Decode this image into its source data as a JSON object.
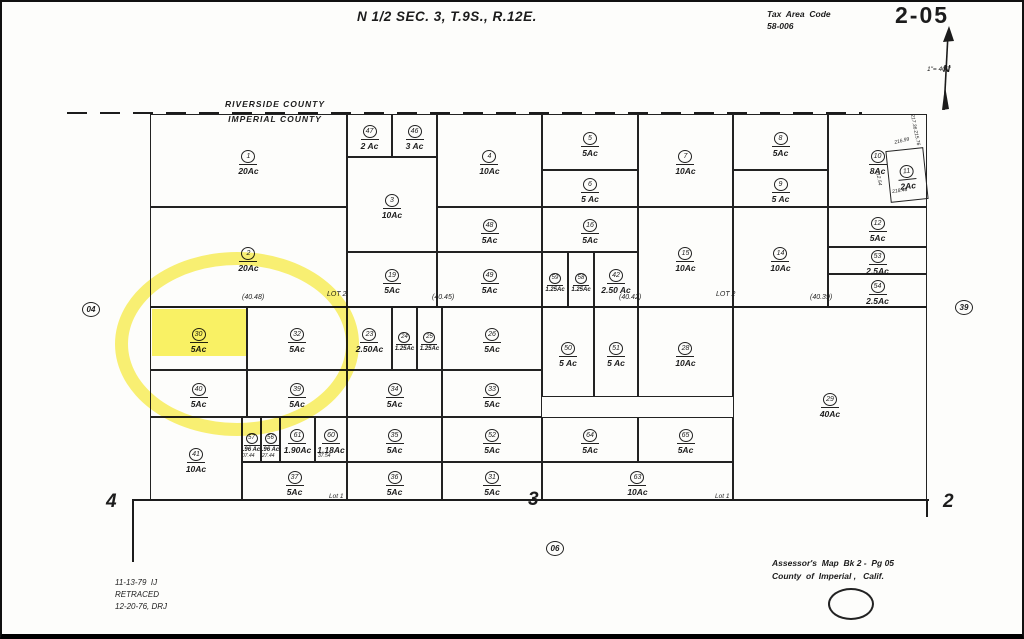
{
  "page": {
    "title": "N 1/2  SEC. 3,  T.9S.,  R.12E.",
    "tax_area_code_label": "Tax  Area  Code",
    "tax_area_code": "58-006",
    "page_number": "2-05",
    "scale": "1\"= 400'",
    "north_label": "N"
  },
  "county_line": {
    "top": "RIVERSIDE  COUNTY",
    "bottom": "IMPERIAL  COUNTY"
  },
  "footer": {
    "note_line1": "11-13-79  IJ",
    "note_line2": "RETRACED",
    "note_line3": "12-20-76, DRJ",
    "credit_line1": "Assessor's  Map  Bk 2 -  Pg 05",
    "credit_line2": "County  of  Imperial ,   Calif."
  },
  "highlight": {
    "color_stroke": "rgba(247,233,30,0.62)",
    "color_fill": "rgba(249,238,42,0.72)",
    "ellipse": {
      "x": 113,
      "y": 250,
      "w": 218,
      "h": 158
    },
    "rect": {
      "x": 150,
      "y": 307,
      "w": 94,
      "h": 47
    }
  },
  "map": {
    "parcels": [
      {
        "id": "1",
        "acres": "20Ac",
        "x": 148,
        "y": 112,
        "w": 197,
        "h": 93
      },
      {
        "id": "47",
        "acres": "2 Ac",
        "x": 345,
        "y": 112,
        "w": 45,
        "h": 43
      },
      {
        "id": "46",
        "acres": "3 Ac",
        "x": 390,
        "y": 112,
        "w": 45,
        "h": 43
      },
      {
        "id": "4",
        "acres": "10Ac",
        "x": 435,
        "y": 112,
        "w": 105,
        "h": 93
      },
      {
        "id": "5",
        "acres": "5Ac",
        "x": 540,
        "y": 112,
        "w": 96,
        "h": 56
      },
      {
        "id": "6",
        "acres": "5 Ac",
        "x": 540,
        "y": 168,
        "w": 96,
        "h": 37
      },
      {
        "id": "7",
        "acres": "10Ac",
        "x": 636,
        "y": 112,
        "w": 95,
        "h": 93
      },
      {
        "id": "8",
        "acres": "5Ac",
        "x": 731,
        "y": 112,
        "w": 95,
        "h": 56
      },
      {
        "id": "9",
        "acres": "5 Ac",
        "x": 731,
        "y": 168,
        "w": 95,
        "h": 37
      },
      {
        "id": "10",
        "acres": "8Ac",
        "x": 826,
        "y": 112,
        "w": 99,
        "h": 93
      },
      {
        "id": "3",
        "acres": "10Ac",
        "x": 345,
        "y": 155,
        "w": 90,
        "h": 95
      },
      {
        "id": "48",
        "acres": "5Ac",
        "x": 435,
        "y": 205,
        "w": 105,
        "h": 45
      },
      {
        "id": "16",
        "acres": "5Ac",
        "x": 540,
        "y": 205,
        "w": 96,
        "h": 45
      },
      {
        "id": "12",
        "acres": "5Ac",
        "x": 826,
        "y": 205,
        "w": 99,
        "h": 40
      },
      {
        "id": "2",
        "acres": "20Ac",
        "x": 148,
        "y": 205,
        "w": 197,
        "h": 100
      },
      {
        "id": "19",
        "acres": "5Ac",
        "x": 345,
        "y": 250,
        "w": 90,
        "h": 55
      },
      {
        "id": "49",
        "acres": "5Ac",
        "x": 435,
        "y": 250,
        "w": 105,
        "h": 55
      },
      {
        "id": "59",
        "acres": "1.25Ac",
        "x": 540,
        "y": 250,
        "w": 26,
        "h": 55
      },
      {
        "id": "58",
        "acres": "1.25Ac",
        "x": 566,
        "y": 250,
        "w": 26,
        "h": 55
      },
      {
        "id": "42",
        "acres": "2.50 Ac",
        "x": 592,
        "y": 250,
        "w": 44,
        "h": 55
      },
      {
        "id": "15",
        "acres": "10Ac",
        "x": 636,
        "y": 205,
        "w": 95,
        "h": 100
      },
      {
        "id": "14",
        "acres": "10Ac",
        "x": 731,
        "y": 205,
        "w": 95,
        "h": 100
      },
      {
        "id": "53",
        "acres": "2.5Ac",
        "x": 826,
        "y": 245,
        "w": 99,
        "h": 27
      },
      {
        "id": "54",
        "acres": "2.5Ac",
        "x": 826,
        "y": 272,
        "w": 99,
        "h": 33
      },
      {
        "id": "30",
        "acres": "5Ac",
        "x": 148,
        "y": 305,
        "w": 97,
        "h": 63
      },
      {
        "id": "32",
        "acres": "5Ac",
        "x": 245,
        "y": 305,
        "w": 100,
        "h": 63
      },
      {
        "id": "23",
        "acres": "2.50Ac",
        "x": 345,
        "y": 305,
        "w": 45,
        "h": 63
      },
      {
        "id": "24",
        "acres": "1.25Ac",
        "x": 390,
        "y": 305,
        "w": 25,
        "h": 63
      },
      {
        "id": "25",
        "acres": "1.25Ac",
        "x": 415,
        "y": 305,
        "w": 25,
        "h": 63
      },
      {
        "id": "26",
        "acres": "5Ac",
        "x": 440,
        "y": 305,
        "w": 100,
        "h": 63
      },
      {
        "id": "50",
        "acres": "5 Ac",
        "x": 540,
        "y": 305,
        "w": 52,
        "h": 90
      },
      {
        "id": "51",
        "acres": "5 Ac",
        "x": 592,
        "y": 305,
        "w": 44,
        "h": 90
      },
      {
        "id": "28",
        "acres": "10Ac",
        "x": 636,
        "y": 305,
        "w": 95,
        "h": 90
      },
      {
        "id": "29",
        "acres": "40Ac",
        "x": 731,
        "y": 305,
        "w": 194,
        "h": 193
      },
      {
        "id": "40",
        "acres": "5Ac",
        "x": 148,
        "y": 368,
        "w": 97,
        "h": 47
      },
      {
        "id": "39",
        "acres": "5Ac",
        "x": 245,
        "y": 368,
        "w": 100,
        "h": 47
      },
      {
        "id": "34",
        "acres": "5Ac",
        "x": 345,
        "y": 368,
        "w": 95,
        "h": 47
      },
      {
        "id": "33",
        "acres": "5Ac",
        "x": 440,
        "y": 368,
        "w": 100,
        "h": 47
      },
      {
        "id": "41",
        "acres": "10Ac",
        "x": 148,
        "y": 415,
        "w": 92,
        "h": 83
      },
      {
        "id": "57",
        "acres": ".96 Ac",
        "x": 240,
        "y": 415,
        "w": 19,
        "h": 45
      },
      {
        "id": "56",
        "acres": ".96 Ac",
        "x": 259,
        "y": 415,
        "w": 19,
        "h": 45
      },
      {
        "id": "61",
        "acres": "1.90Ac",
        "x": 278,
        "y": 415,
        "w": 35,
        "h": 45
      },
      {
        "id": "60",
        "acres": "1.18Ac",
        "x": 313,
        "y": 415,
        "w": 32,
        "h": 45
      },
      {
        "id": "35",
        "acres": "5Ac",
        "x": 345,
        "y": 415,
        "w": 95,
        "h": 45
      },
      {
        "id": "52",
        "acres": "5Ac",
        "x": 440,
        "y": 415,
        "w": 100,
        "h": 45
      },
      {
        "id": "64",
        "acres": "5Ac",
        "x": 540,
        "y": 415,
        "w": 96,
        "h": 45
      },
      {
        "id": "65",
        "acres": "5Ac",
        "x": 636,
        "y": 415,
        "w": 95,
        "h": 45
      },
      {
        "id": "37",
        "acres": "5Ac",
        "x": 240,
        "y": 460,
        "w": 105,
        "h": 38
      },
      {
        "id": "36",
        "acres": "5Ac",
        "x": 345,
        "y": 460,
        "w": 95,
        "h": 38
      },
      {
        "id": "31",
        "acres": "5Ac",
        "x": 440,
        "y": 460,
        "w": 100,
        "h": 38
      },
      {
        "id": "63",
        "acres": "10Ac",
        "x": 540,
        "y": 460,
        "w": 191,
        "h": 38
      },
      {
        "id": "11",
        "acres": "2Ac",
        "x": 886,
        "y": 147,
        "w": 38,
        "h": 52,
        "rot": -6
      }
    ],
    "circled": [
      {
        "t": "04",
        "x": 80,
        "y": 300
      },
      {
        "t": "39",
        "x": 953,
        "y": 298
      },
      {
        "t": "06",
        "x": 544,
        "y": 539
      }
    ],
    "texts": [
      {
        "t": "LOT 2",
        "x": 325,
        "y": 289,
        "fs": 7
      },
      {
        "t": "LOT 2",
        "x": 714,
        "y": 289,
        "fs": 7
      },
      {
        "t": "(40.48)",
        "x": 240,
        "y": 292,
        "fs": 7
      },
      {
        "t": "(40.45)",
        "x": 430,
        "y": 292,
        "fs": 7
      },
      {
        "t": "(40.42)",
        "x": 617,
        "y": 292,
        "fs": 7
      },
      {
        "t": "(40.39)",
        "x": 808,
        "y": 292,
        "fs": 7
      },
      {
        "t": "Lot 1",
        "x": 327,
        "y": 492,
        "fs": 6.5
      },
      {
        "t": "Lot 1",
        "x": 713,
        "y": 492,
        "fs": 6.5
      },
      {
        "t": "4",
        "x": 104,
        "y": 490,
        "fs": 19,
        "b": 1
      },
      {
        "t": "3",
        "x": 526,
        "y": 488,
        "fs": 19,
        "b": 1
      },
      {
        "t": "2",
        "x": 941,
        "y": 490,
        "fs": 19,
        "b": 1
      },
      {
        "t": "07.44",
        "x": 240,
        "y": 452,
        "fs": 5
      },
      {
        "t": "27.44",
        "x": 260,
        "y": 452,
        "fs": 5
      },
      {
        "t": "37.54",
        "x": 316,
        "y": 452,
        "fs": 5
      },
      {
        "t": "216.99",
        "x": 892,
        "y": 139,
        "fs": 5,
        "rot": -14
      },
      {
        "t": "218.48",
        "x": 890,
        "y": 188,
        "fs": 5,
        "rot": -8
      },
      {
        "t": "215.76",
        "x": 915,
        "y": 128,
        "fs": 5,
        "rot": 78
      },
      {
        "t": "212.54",
        "x": 877,
        "y": 168,
        "fs": 5,
        "rot": 80
      },
      {
        "t": "217.36",
        "x": 912,
        "y": 112,
        "fs": 5,
        "rot": 80
      }
    ],
    "lines": [
      {
        "x": 148,
        "y": 304,
        "w": 777,
        "h": 2
      },
      {
        "x": 130,
        "y": 497,
        "w": 797,
        "h": 2
      },
      {
        "x": 130,
        "y": 497,
        "w": 2,
        "h": 63
      },
      {
        "x": 924,
        "y": 497,
        "w": 2,
        "h": 18
      }
    ]
  }
}
